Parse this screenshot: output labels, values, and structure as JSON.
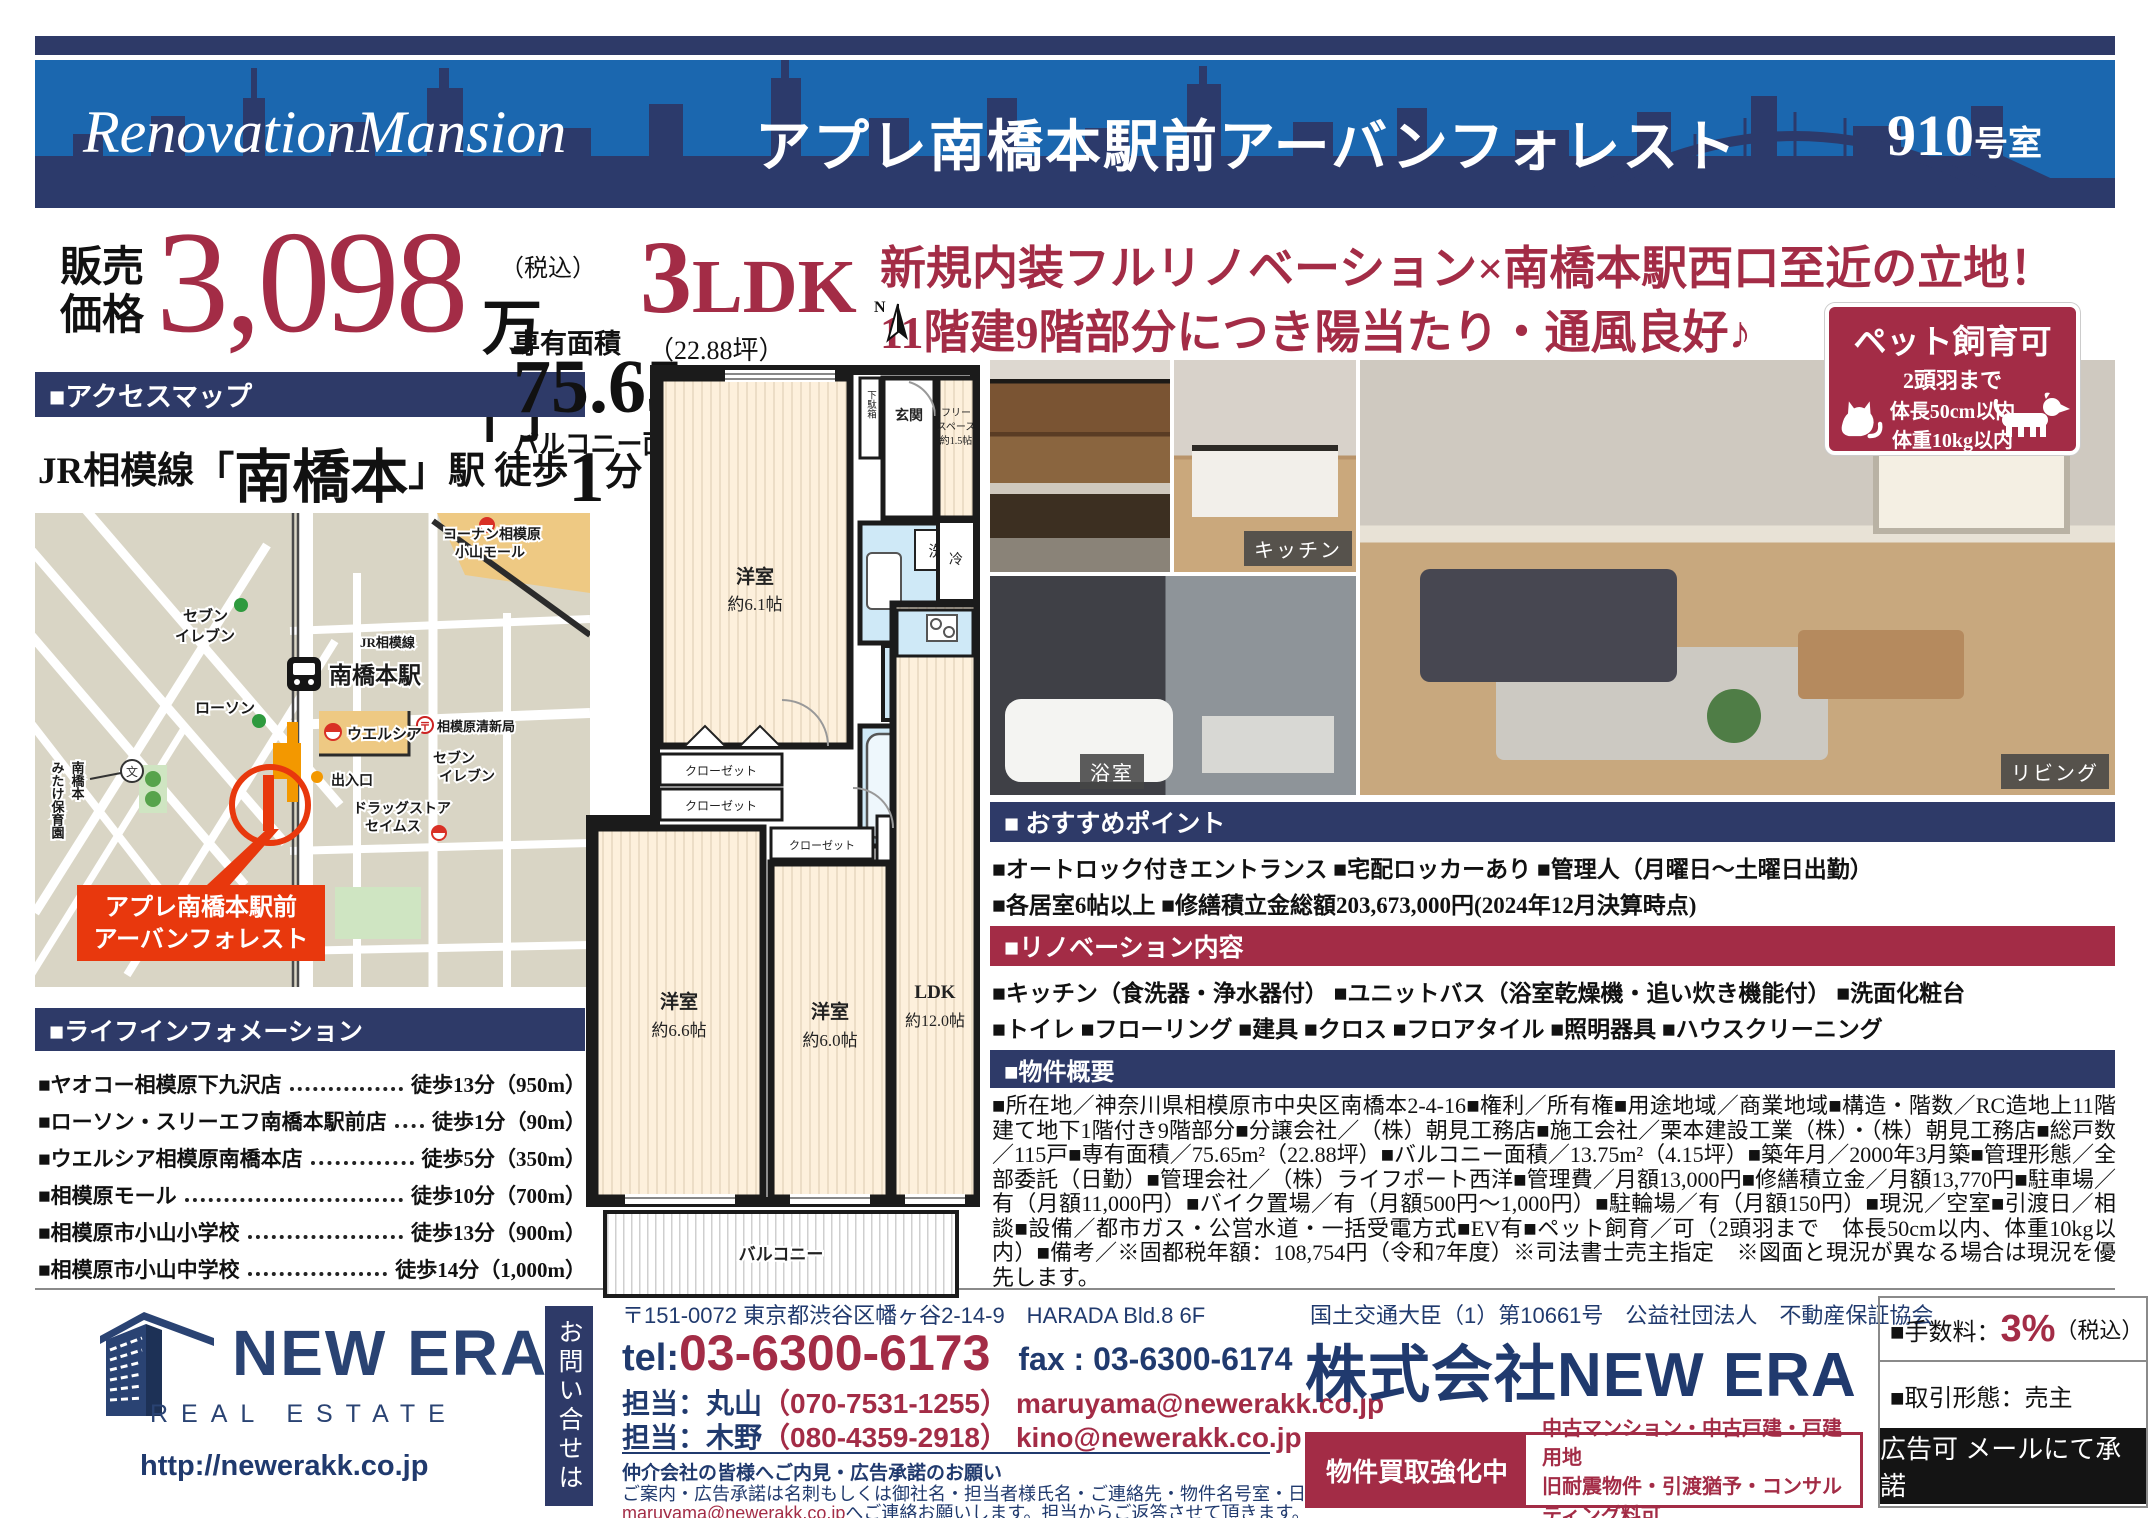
{
  "header": {
    "brand": "RenovationMansion",
    "title": "アプレ南橋本駅前アーバンフォレスト",
    "room_no": "910",
    "room_suffix": "号室"
  },
  "price": {
    "label1": "販売",
    "label2": "価格",
    "amount": "3,098",
    "tax": "（税込）",
    "unit": "万円"
  },
  "type": {
    "big": "3",
    "rest": "LDK"
  },
  "area": {
    "label": "専有面積",
    "tsubo": "（22.88坪）",
    "value": "75.65",
    "unit": "m",
    "sup": "2",
    "balcony": "バルコニー面積：13.75m²（4.15坪）"
  },
  "catch": {
    "line1": "新規内装フルリノベーション×南橋本駅西口至近の立地！",
    "line2": "11階建9階部分につき陽当たり・通風良好♪"
  },
  "pet_box": {
    "title": "ペット飼育可",
    "line1": "2頭羽まで",
    "line2": "体長50cm以内",
    "line3": "体重10kg以内"
  },
  "access": {
    "section": "■アクセスマップ",
    "rail": "JR相模線",
    "bracket_l": "「",
    "station": "南橋本",
    "bracket_r": "」",
    "suffix": "駅 徒歩",
    "min": "1",
    "min_unit": "分"
  },
  "map": {
    "mall1": "コーナン相模原",
    "mall2": "小山モール",
    "seven_l1": "セブン",
    "seven_l2": "イレブン",
    "rail": "JR相模線",
    "station": "南橋本駅",
    "lawson": "ローソン",
    "welcia": "ウエルシア",
    "post": "相模原清新局",
    "seven_r1": "セブン",
    "seven_r2": "イレブン",
    "exit": "出入口",
    "drug1": "ドラッグストア",
    "drug2": "セイムス",
    "nursery1": "南橋本",
    "nursery2": "みたけ保育園",
    "school_mark": "文",
    "callout1": "アプレ南橋本駅前",
    "callout2": "アーバンフォレスト"
  },
  "life_info": {
    "section": "■ライフインフォメーション",
    "items": [
      {
        "name": "■ヤオコー相模原下九沢店",
        "walk": "徒歩13分（950m）"
      },
      {
        "name": "■ローソン・スリーエフ南橋本駅前店",
        "walk": "徒歩1分（90m）"
      },
      {
        "name": "■ウエルシア相模原南橋本店",
        "walk": "徒歩5分（350m）"
      },
      {
        "name": "■相模原モール",
        "walk": "徒歩10分（700m）"
      },
      {
        "name": "■相模原市小山小学校",
        "walk": "徒歩13分（900m）"
      },
      {
        "name": "■相模原市小山中学校",
        "walk": "徒歩14分（1,000m）"
      }
    ]
  },
  "plan": {
    "north": "N",
    "r61": "洋室",
    "r61s": "約6.1帖",
    "washroom": "洗面室",
    "washer": "洗",
    "genkan": "玄関",
    "shoebox": "下駄箱",
    "free1": "フリー",
    "free2": "スペース",
    "free3": "約1.5帖",
    "toilet": "トイレ",
    "fridge": "冷",
    "bath": "浴室",
    "closet1": "クローゼット",
    "closet2": "クローゼット",
    "closet3": "クローゼット",
    "storage": "収納",
    "r66": "洋室",
    "r66s": "約6.6帖",
    "r60": "洋室",
    "r60s": "約6.0帖",
    "ldk": "LDK",
    "ldks": "約12.0帖",
    "balcony": "バルコニー"
  },
  "photos": {
    "kitchen_label": "キッチン",
    "bath_label": "浴室",
    "living_label": "リビング"
  },
  "points": {
    "section": "■ おすすめポイント",
    "line1": "■オートロック付きエントランス ■宅配ロッカーあり ■管理人（月曜日～土曜日出勤）",
    "line2": "■各居室6帖以上 ■修繕積立金総額203,673,000円(2024年12月決算時点)"
  },
  "renovation": {
    "section": "■リノベーション内容",
    "line1": "■キッチン（食洗器・浄水器付） ■ユニットバス（浴室乾燥機・追い炊き機能付） ■洗面化粧台",
    "line2": "■トイレ ■フローリング ■建具 ■クロス ■フロアタイル ■照明器具 ■ハウスクリーニング"
  },
  "outline": {
    "section": "■物件概要",
    "text": "■所在地／神奈川県相模原市中央区南橋本2-4-16■権利／所有権■用途地域／商業地域■構造・階数／RC造地上11階建て地下1階付き9階部分■分譲会社／（株）朝見工務店■施工会社／栗本建設工業（株）・（株）朝見工務店■総戸数／115戸■専有面積／75.65m²（22.88坪）■バルコニー面積／13.75m²（4.15坪）■築年月／2000年3月築■管理形態／全部委託（日勤）■管理会社／（株）ライフポート西洋■管理費／月額13,000円■修繕積立金／月額13,770円■駐車場／有（月額11,000円）■バイク置場／有（月額500円～1,000円）■駐輪場／有（月額150円）■現況／空室■引渡日／相談■設備／都市ガス・公営水道・一括受電方式■EV有■ペット飼育／可（2頭羽まで　体長50cm以内、体重10kg以内）■備考／※固都税年額：108,754円（令和7年度）※司法書士売主指定　※図面と現況が異なる場合は現況を優先します。"
  },
  "footer": {
    "logo_name": "NEW ERA",
    "logo_sub": "REAL ESTATE",
    "url": "http://newerakk.co.jp",
    "inquiry_vertical": "お問い合せは",
    "address": "〒151-0072 東京都渋谷区幡ヶ谷2-14-9　HARADA Bld.8 6F",
    "tel_label": "tel:",
    "tel": "03-6300-6173",
    "fax": "fax : 03-6300-6174",
    "staff1_label": "担当：丸山",
    "staff1_phone": "（070-7531-1255）",
    "staff1_mail": "maruyama@newerakk.co.jp",
    "staff2_label": "担当：木野",
    "staff2_phone": "（080-4359-2918）",
    "staff2_mail": "kino@newerakk.co.jp",
    "notice_title": "仲介会社の皆様へご内見・広告承諾のお願い",
    "notice_body1": "ご案内・広告承諾は名刺もしくは御社名・担当者様氏名・ご連絡先・物件名号室・日時を記載の上",
    "notice_mail": "maruyama@newerakk.co.jp",
    "notice_body2": "へご連絡お願いします。担当からご返答させて頂きます。",
    "license": "国土交通大臣（1）第10661号　公益社団法人　不動産保証協会",
    "company": "株式会社NEW ERA",
    "buy_title": "物件買取強化中",
    "buy_line1": "中古マンション・中古戸建・戸建用地",
    "buy_line2": "旧耐震物件・引渡猶予・コンサルティング料可",
    "fee_label": "■手数料：",
    "fee_value": "3%",
    "fee_tax": "（税込）",
    "deal": "■取引形態：売主",
    "ad": "広告可 メールにて承諾"
  }
}
